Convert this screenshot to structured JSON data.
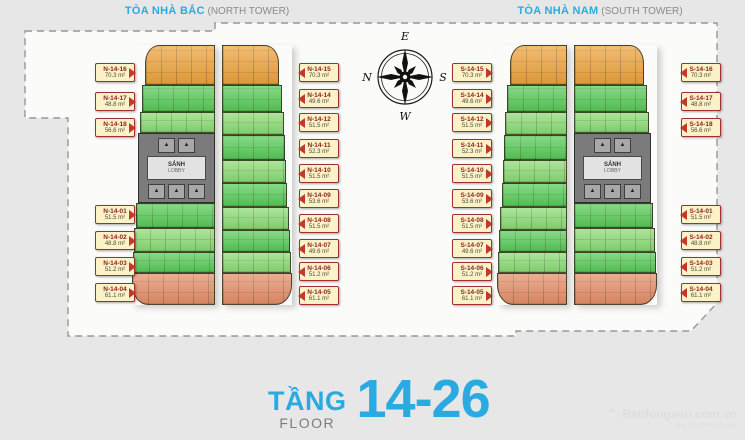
{
  "header": {
    "north_title": "TÒA NHÀ BẮC",
    "north_sub": " (NORTH TOWER)",
    "south_title": "TÒA NHÀ NAM",
    "south_sub": " (SOUTH TOWER)"
  },
  "compass": {
    "top": "E",
    "left": "N",
    "right": "S",
    "bottom": "W"
  },
  "core": {
    "lobby": "SẢNH",
    "lobby_sub": "LOBBY"
  },
  "footer": {
    "tang": "TẦNG",
    "floor": "FLOOR",
    "range": "14-26"
  },
  "watermark": {
    "logo": "⌃",
    "name": "Batdongsan.com.vn",
    "sub": "by PropertyGuru"
  },
  "palette": {
    "accent_cyan": "#29ABE2",
    "unit_orange": "#EDA33C",
    "unit_green_bright": "#58CB58",
    "unit_green_light": "#8BDB74",
    "unit_salmon": "#E58E68",
    "core_gray": "#7B7B7B",
    "label_bg": "#FBF2C8",
    "label_border": "#A03030",
    "label_text": "#8B1E1E",
    "arrow_red": "#C0392B"
  },
  "north": {
    "left": [
      {
        "code": "N-14-16",
        "area": "70.3 m²"
      },
      {
        "code": "N-14-17",
        "area": "48.8 m²"
      },
      {
        "code": "N-14-18",
        "area": "56.6 m²"
      },
      {
        "code": "N-14-01",
        "area": "51.5 m²"
      },
      {
        "code": "N-14-02",
        "area": "48.8 m²"
      },
      {
        "code": "N-14-03",
        "area": "51.2 m²"
      },
      {
        "code": "N-14-04",
        "area": "61.1 m²"
      }
    ],
    "right": [
      {
        "code": "N-14-15",
        "area": "70.3 m²"
      },
      {
        "code": "N-14-14",
        "area": "49.6 m²"
      },
      {
        "code": "N-14-12",
        "area": "51.5 m²"
      },
      {
        "code": "N-14-11",
        "area": "52.3 m²"
      },
      {
        "code": "N-14-10",
        "area": "51.5 m²"
      },
      {
        "code": "N-14-09",
        "area": "53.6 m²"
      },
      {
        "code": "N-14-08",
        "area": "51.5 m²"
      },
      {
        "code": "N-14-07",
        "area": "49.6 m²"
      },
      {
        "code": "N-14-06",
        "area": "51.2 m²"
      },
      {
        "code": "N-14-05",
        "area": "61.1 m²"
      }
    ]
  },
  "south": {
    "left": [
      {
        "code": "S-14-15",
        "area": "70.3 m²"
      },
      {
        "code": "S-14-14",
        "area": "49.6 m²"
      },
      {
        "code": "S-14-12",
        "area": "51.5 m²"
      },
      {
        "code": "S-14-11",
        "area": "52.3 m²"
      },
      {
        "code": "S-14-10",
        "area": "51.5 m²"
      },
      {
        "code": "S-14-09",
        "area": "53.6 m²"
      },
      {
        "code": "S-14-08",
        "area": "51.5 m²"
      },
      {
        "code": "S-14-07",
        "area": "49.6 m²"
      },
      {
        "code": "S-14-06",
        "area": "51.2 m²"
      },
      {
        "code": "S-14-05",
        "area": "61.1 m²"
      }
    ],
    "right": [
      {
        "code": "S-14-16",
        "area": "70.3 m²"
      },
      {
        "code": "S-14-17",
        "area": "48.8 m²"
      },
      {
        "code": "S-14-18",
        "area": "56.6 m²"
      },
      {
        "code": "S-14-01",
        "area": "51.5 m²"
      },
      {
        "code": "S-14-02",
        "area": "48.8 m²"
      },
      {
        "code": "S-14-03",
        "area": "51.2 m²"
      },
      {
        "code": "S-14-04",
        "area": "61.1 m²"
      }
    ]
  }
}
